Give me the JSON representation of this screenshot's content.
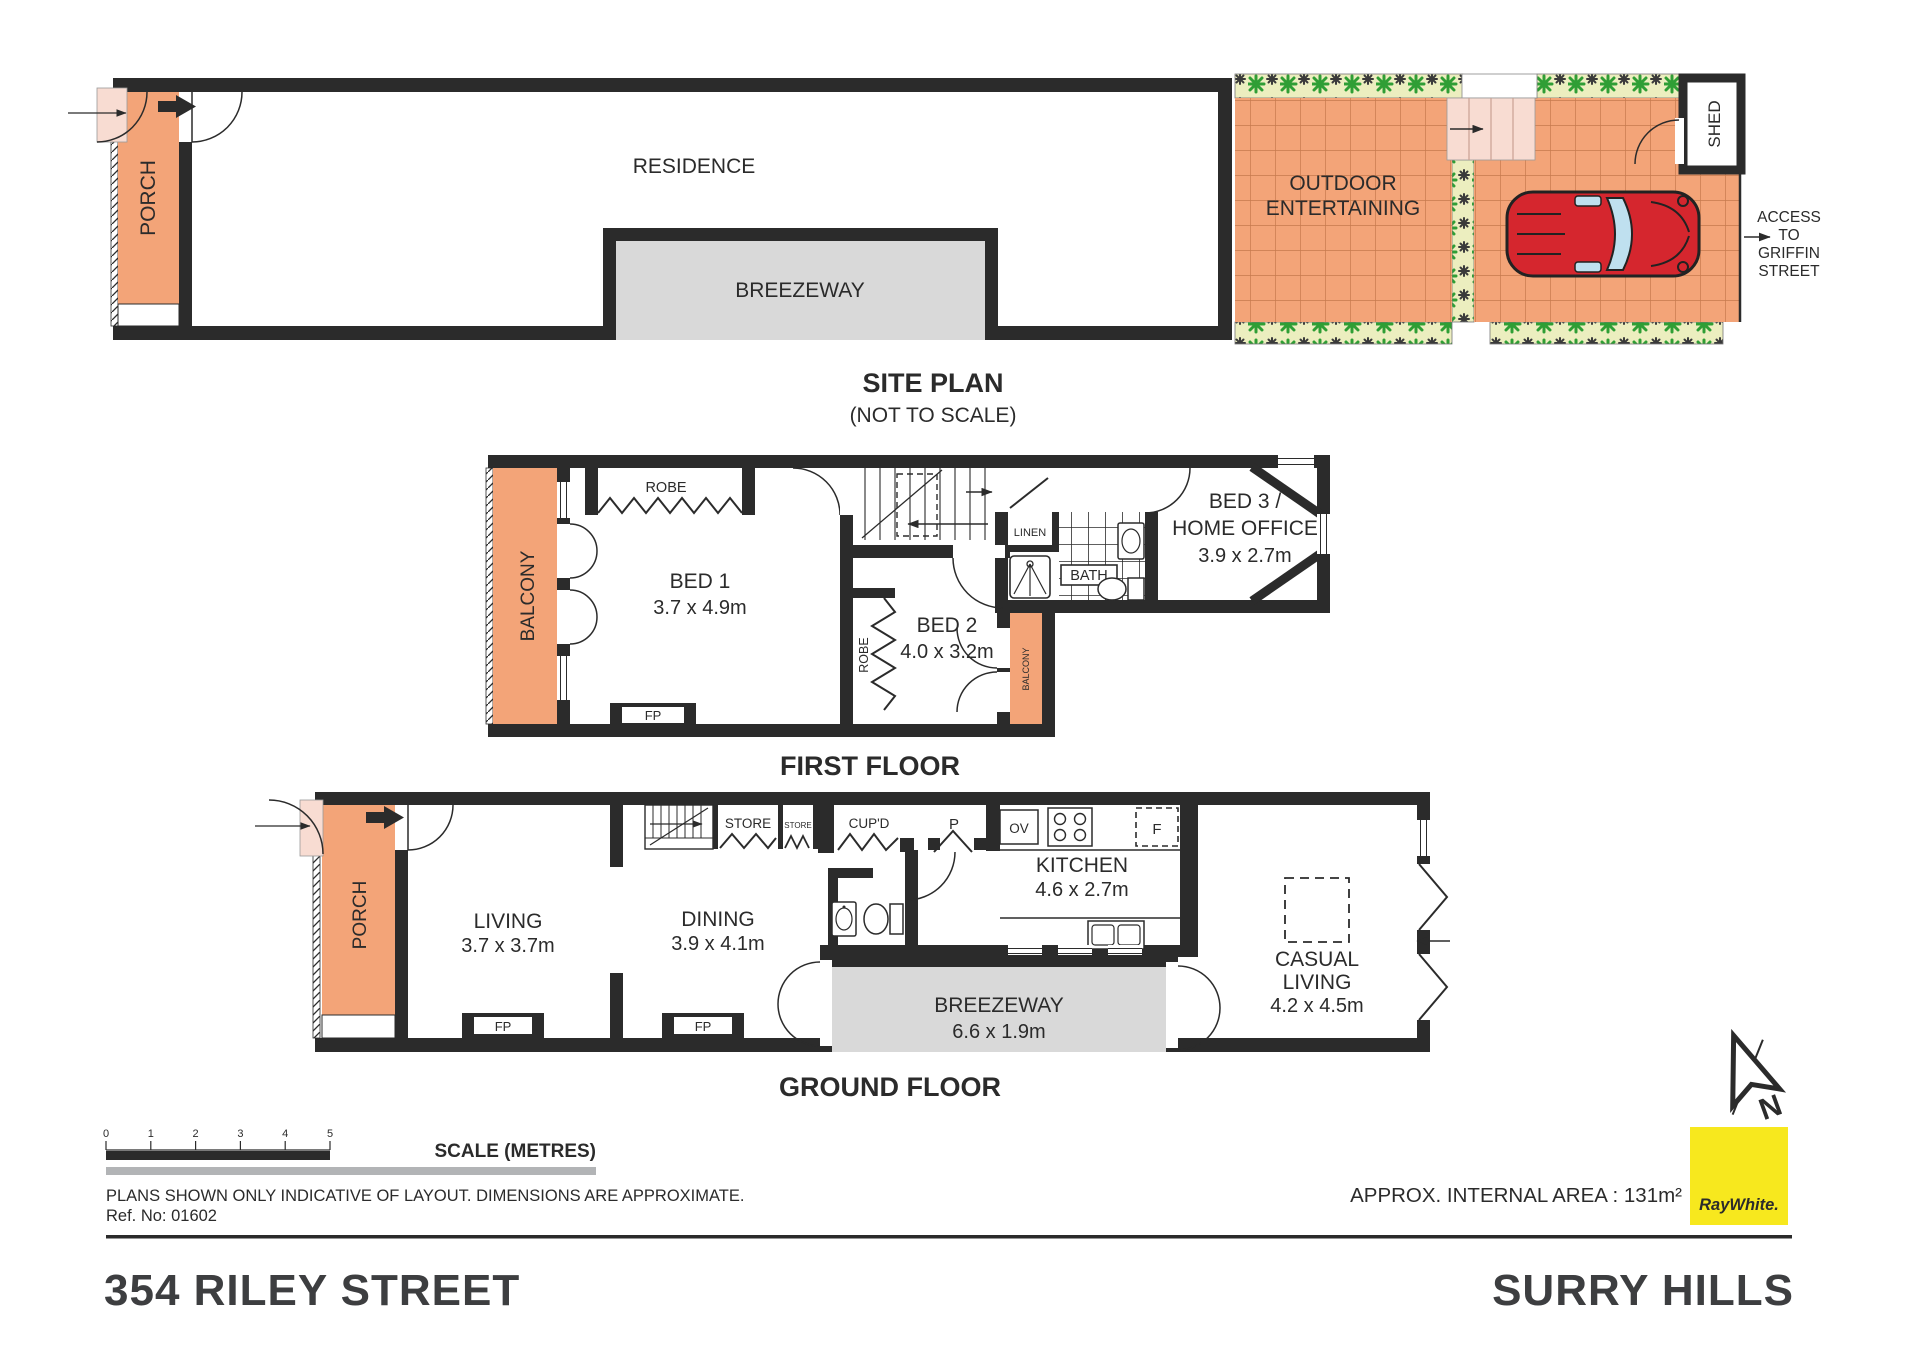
{
  "site_plan": {
    "title": "SITE PLAN",
    "subtitle": "(NOT TO SCALE)",
    "residence": "RESIDENCE",
    "porch": "PORCH",
    "breezeway": "BREEZEWAY",
    "outdoor_line1": "OUTDOOR",
    "outdoor_line2": "ENTERTAINING",
    "shed": "SHED",
    "access_line1": "ACCESS",
    "access_line2": "TO",
    "access_line3": "GRIFFIN",
    "access_line4": "STREET"
  },
  "first_floor": {
    "title": "FIRST FLOOR",
    "balcony_left": "BALCONY",
    "robe_top": "ROBE",
    "bed1_name": "BED 1",
    "bed1_dims": "3.7 x 4.9m",
    "fp": "FP",
    "bed2_name": "BED 2",
    "bed2_dims": "4.0 x 3.2m",
    "bed2_robe": "ROBE",
    "bed2_balcony": "BALCONY",
    "linen": "LINEN",
    "bath": "BATH",
    "bed3_line1": "BED 3 /",
    "bed3_line2": "HOME OFFICE",
    "bed3_dims": "3.9 x 2.7m"
  },
  "ground_floor": {
    "title": "GROUND FLOOR",
    "porch": "PORCH",
    "living_name": "LIVING",
    "living_dims": "3.7 x 3.7m",
    "fp_living": "FP",
    "dining_name": "DINING",
    "dining_dims": "3.9 x 4.1m",
    "fp_dining": "FP",
    "store_large": "STORE",
    "store_small": "STORE",
    "cupd": "CUP'D",
    "pantry": "P",
    "oven": "OV",
    "fridge": "F",
    "kitchen_name": "KITCHEN",
    "kitchen_dims": "4.6 x 2.7m",
    "breezeway_name": "BREEZEWAY",
    "breezeway_dims": "6.6 x 1.9m",
    "casual_line1": "CASUAL",
    "casual_line2": "LIVING",
    "casual_dims": "4.2 x 4.5m"
  },
  "footer": {
    "scale_title": "SCALE (METRES)",
    "scale_ticks": [
      "0",
      "1",
      "2",
      "3",
      "4",
      "5"
    ],
    "disclaimer": "PLANS SHOWN ONLY INDICATIVE OF LAYOUT.  DIMENSIONS ARE APPROXIMATE.",
    "ref_no": "Ref. No: 01602",
    "area": "APPROX. INTERNAL AREA : 131m²",
    "address": "354 RILEY STREET",
    "suburb": "SURRY HILLS",
    "agency": "RayWhite.",
    "north": "N"
  },
  "colors": {
    "wall": "#2b2b2b",
    "terracotta": "#f3a478",
    "tile_line": "#c67a4e",
    "step_pink": "#f8dcd2",
    "garden": "#eceebf",
    "plant_green": "#2f9e35",
    "breezeway_gray": "#d9d9d9",
    "car_red": "#d5262e",
    "car_glass": "#bfe0ef",
    "brand_yellow": "#f7e81e"
  }
}
